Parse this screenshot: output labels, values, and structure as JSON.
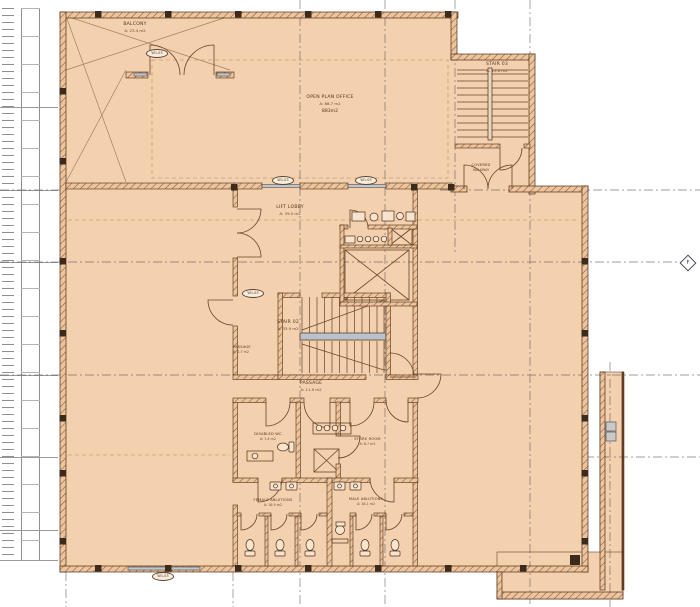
{
  "drawing": {
    "kind": "architectural floor plan",
    "rooms": {
      "balcony": {
        "name": "BALCONY",
        "area": "A: 23.4 m2"
      },
      "open_plan_office": {
        "name": "OPEN PLAN OFFICE",
        "area": "A: 88.7 m2",
        "note": "883m2"
      },
      "stair_03": {
        "name": "STAIR 03",
        "area": "A: 15.0 m2"
      },
      "covered_link": {
        "name": "COVERED",
        "area": "WALKWAY"
      },
      "lift_lobby": {
        "name": "LIFT LOBBY",
        "area": "A: 39.5 m2"
      },
      "stair_02": {
        "name": "STAIR 02",
        "area": "A: 33.9 m2"
      },
      "fire_passage": {
        "name": "PASSAGE",
        "area": "A: 1.7 m2"
      },
      "passage": {
        "name": "PASSAGE",
        "area": "A: 11.9 m2"
      },
      "disabled_wc": {
        "name": "DISABLED WC",
        "area": "A: 3.4 m2"
      },
      "store_room": {
        "name": "STORE ROOM",
        "area": "A: 6.7 m2"
      },
      "female_ablutions": {
        "name": "FEMALE ABLUTIONS",
        "area": "A: 16.9 m2"
      },
      "male_ablutions": {
        "name": "MALE ABLUTIONS",
        "area": "A: 16.1 m2"
      }
    },
    "tags": [
      {
        "label": "W1.03"
      },
      {
        "label": "W1.03"
      },
      {
        "label": "W1.03"
      },
      {
        "label": "W1.03"
      },
      {
        "label": "W1.03"
      }
    ],
    "grid": {
      "bubble_label": "F"
    },
    "colors": {
      "floor": "#f3d0ae",
      "wall": "#4f3018",
      "hatch": "#8a5836",
      "grid_line": "#4c4658",
      "glazing": "#b9c7d6",
      "ruler": "#8f8f8f"
    }
  }
}
